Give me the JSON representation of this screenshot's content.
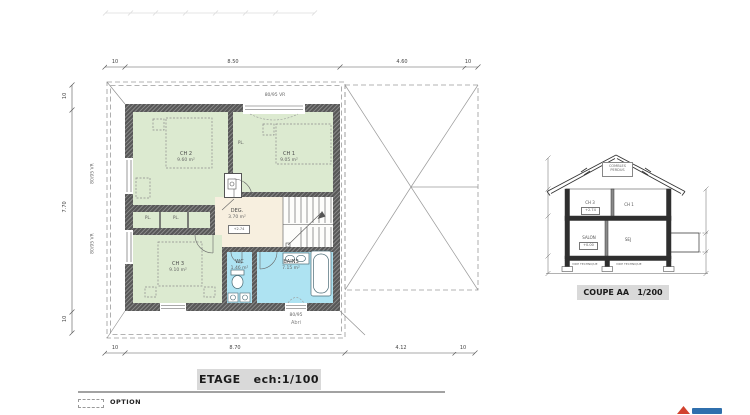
{
  "plan": {
    "title": "ETAGE   ech:1/100",
    "rooms": {
      "ch2": {
        "name": "CH 2",
        "area": "9.60 m²"
      },
      "ch1": {
        "name": "CH 1",
        "area": "9.05 m²"
      },
      "deg": {
        "name": "DEG.",
        "area": "3.70 m²",
        "level": "+2.74"
      },
      "ch3": {
        "name": "CH 3",
        "area": "9.10 m²"
      },
      "wc": {
        "name": "WC",
        "area": "1.46 m²"
      },
      "bains": {
        "name": "BAINS",
        "area": "7.15 m²"
      }
    },
    "closet_label_1": "PL.",
    "closet_label_2": "PL.",
    "closet_label_3": "PL.",
    "window_top": "80/95 VR",
    "window_left_upper": "80/95 VR",
    "window_left_lower": "80/95 VR",
    "window_bottom": "80/95",
    "abri_label": "Abri",
    "dims": {
      "top": {
        "d1": "10",
        "d2": "8.50",
        "d3": "4.60",
        "d4": "10"
      },
      "bottom": {
        "d1": "10",
        "d2": "8.70",
        "d3": "4.12",
        "d4": "10"
      },
      "left": {
        "d1": "10",
        "d2": "7.70",
        "d3": "10"
      }
    }
  },
  "section": {
    "title": "COUPE AA   1/200",
    "attic_line1": "COMBLES",
    "attic_line2": "PERDUS",
    "upper_left_name": "CH 3",
    "upper_left_level": "+2.74",
    "upper_right_name": "CH 1",
    "lower_left_name": "SALON",
    "lower_left_level": "+0.00",
    "lower_right_name": "SEJ",
    "vide_left": "VIDE TECHNIQUE",
    "vide_right": "VIDE TECHNIQUE"
  },
  "legend": {
    "option_label": "OPTION"
  },
  "colors": {
    "room_green": "#dcead0",
    "room_blue": "#aee3f2",
    "room_beige": "#f7efdf",
    "wall_gray": "#585858",
    "accent_red": "#d2422e",
    "accent_blue": "#2f6fad"
  }
}
